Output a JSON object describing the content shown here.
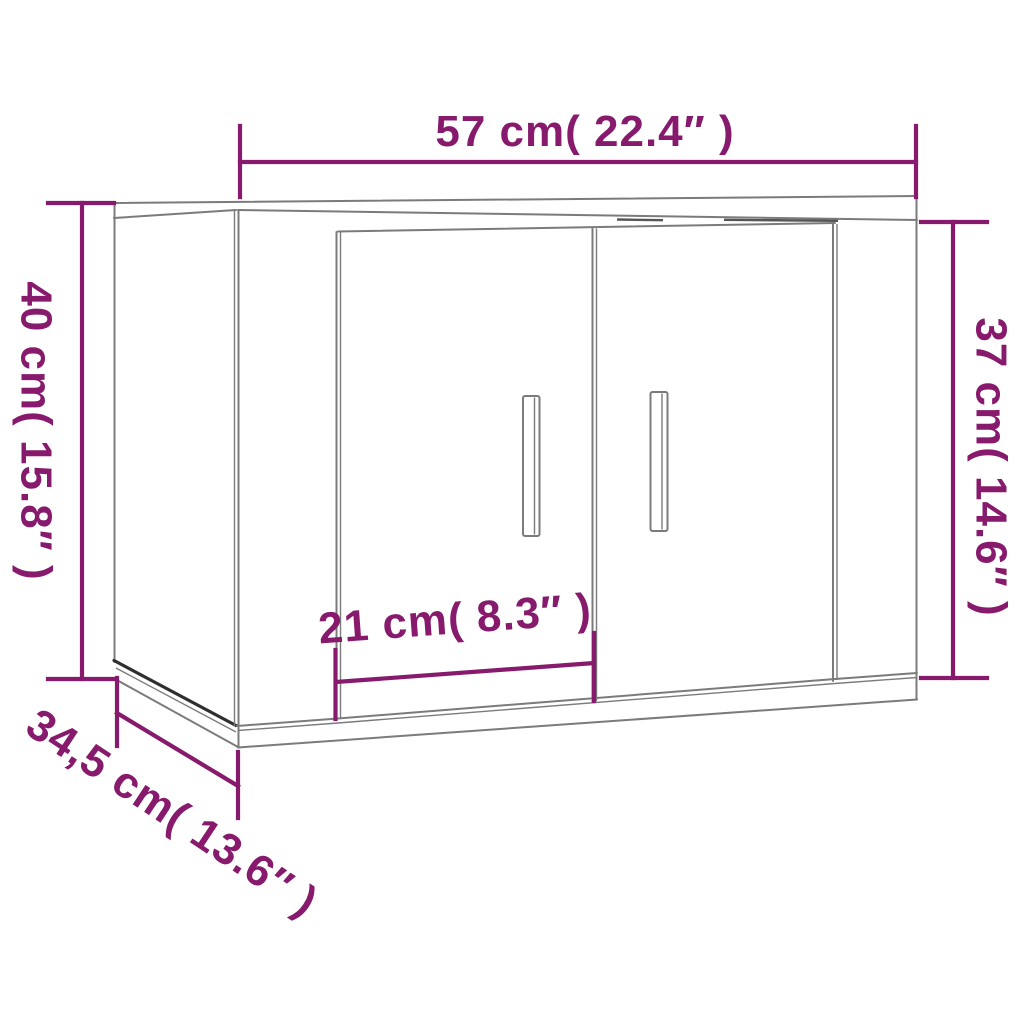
{
  "annotations": {
    "width_top": "57 cm( 22.4″ )",
    "height_left": "40 cm( 15.8″ )",
    "height_right": "37 cm( 14.6″ )",
    "door_width": "21 cm( 8.3″ )",
    "depth": "34,5 cm( 13.6″ )"
  },
  "colors": {
    "dimension_accent": "#871A6C",
    "outline_gray": "#7b7b7b",
    "outline_dark": "#2f2f2f",
    "background": "#ffffff"
  }
}
